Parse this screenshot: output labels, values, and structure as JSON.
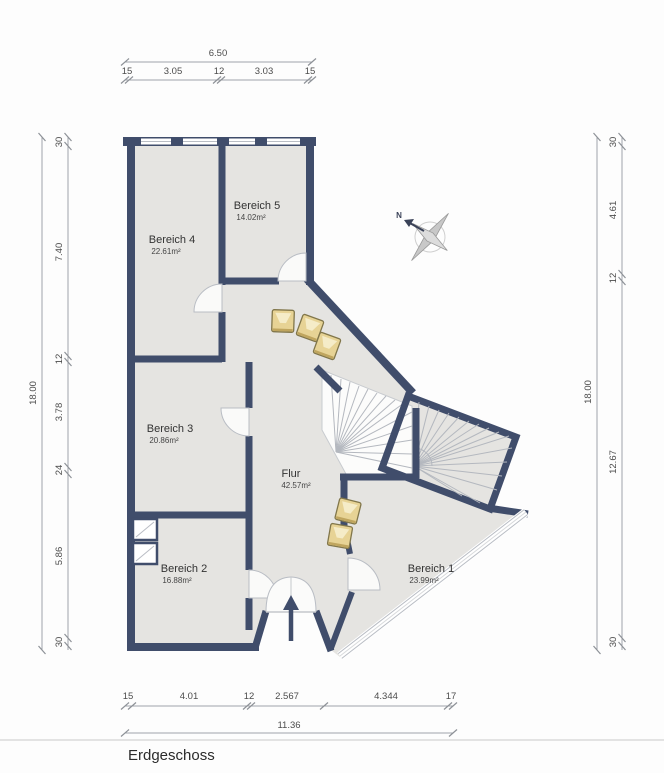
{
  "title": "Erdgeschoss",
  "compass": {
    "north_label": "N"
  },
  "rooms": {
    "bereich1": {
      "name": "Bereich 1",
      "area": "23.99m²"
    },
    "bereich2": {
      "name": "Bereich 2",
      "area": "16.88m²"
    },
    "bereich3": {
      "name": "Bereich 3",
      "area": "20.86m²"
    },
    "bereich4": {
      "name": "Bereich 4",
      "area": "22.61m²"
    },
    "bereich5": {
      "name": "Bereich 5",
      "area": "14.02m²"
    },
    "flur": {
      "name": "Flur",
      "area": "42.57m²"
    }
  },
  "dimensions": {
    "top": {
      "overall": "6.50",
      "segments": [
        "15",
        "3.05",
        "12",
        "3.03",
        "15"
      ]
    },
    "left": {
      "overall": "18.00",
      "segments": [
        "30",
        "7.40",
        "12",
        "3.78",
        "24",
        "5.86",
        "30"
      ]
    },
    "right": {
      "overall": "18.00",
      "segments": [
        "30",
        "4.61",
        "12",
        "12.67",
        "30"
      ]
    },
    "bottom": {
      "overall": "11.36",
      "segments": [
        "15",
        "4.01",
        "12",
        "2.567",
        "4.344",
        "17"
      ]
    }
  },
  "colors": {
    "wall": "#404d6b",
    "floor": "#e5e4e1",
    "box": "#e7d395"
  }
}
